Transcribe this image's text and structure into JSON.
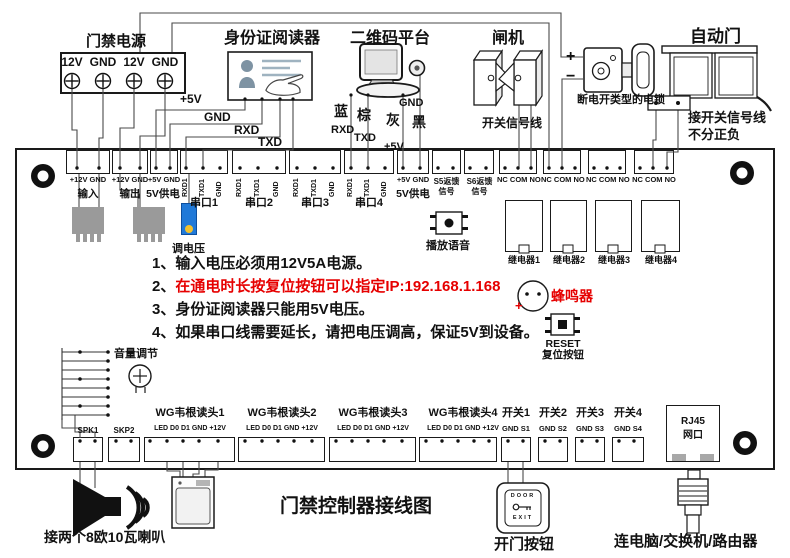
{
  "title": "门禁控制器接线图",
  "colors": {
    "wire": "#4a4a4a",
    "red": "#e60000",
    "pot_blue": "#2079d8",
    "pot_dot": "#f2c12e",
    "chip_gray": "#9a9a9a"
  },
  "top": {
    "power": {
      "title": "门禁电源",
      "t1": "12V",
      "t2": "GND",
      "t3": "12V",
      "t4": "GND"
    },
    "reader": {
      "title": "身份证阅读器",
      "w1": "+5V",
      "w2": "GND",
      "w3": "RXD",
      "w4": "TXD"
    },
    "qr": {
      "title": "二维码平台",
      "c1": "蓝",
      "c2": "棕",
      "c3": "灰",
      "c4": "黑",
      "s1": "RXD",
      "s2": "TXD",
      "s3": "+5V",
      "s4": "GND"
    },
    "gate": {
      "title": "闸机",
      "note": "开关信号线"
    },
    "lock": {
      "plus": "+",
      "minus": "−",
      "label": "断电开类型的电锁"
    },
    "door": {
      "title": "自动门",
      "note1": "接开关信号线",
      "note2": "不分正负"
    }
  },
  "board": {
    "in": {
      "pins": "+12V GND",
      "label": "输入"
    },
    "out": {
      "pins": "+12V GND",
      "label": "输出"
    },
    "v5a": {
      "pins": "+5V GND",
      "label": "5V供电"
    },
    "serial": [
      {
        "p1": "RXD1",
        "p2": "TXD1",
        "p3": "GND",
        "label": "串口1"
      },
      {
        "p1": "RXD1",
        "p2": "TXD1",
        "p3": "GND",
        "label": "串口2"
      },
      {
        "p1": "RXD1",
        "p2": "TXD1",
        "p3": "GND",
        "label": "串口3"
      },
      {
        "p1": "RXD1",
        "p2": "TXD1",
        "p3": "GND",
        "label": "串口4"
      }
    ],
    "v5b": {
      "pins": "+5V GND",
      "label": "5V供电"
    },
    "s5": {
      "l1": "S5返馈",
      "l2": "信号"
    },
    "s6": {
      "l1": "S6返馈",
      "l2": "信号"
    },
    "relay_pins": "NC COM NO",
    "relays": [
      "继电器1",
      "继电器2",
      "继电器3",
      "继电器4"
    ],
    "pot": "调电压",
    "voice": "播放语音",
    "buzzer": {
      "label": "蜂鸣器",
      "plus": "+"
    },
    "reset": {
      "l1": "RESET",
      "l2": "复位按钮"
    },
    "volume": "音量调节",
    "notes": {
      "n1": "1、输入电压必须用12V5A电源。",
      "n2a": "2、",
      "n2b": "在通电时长按复位按钮可以指定IP:192.168.1.168",
      "n3": "3、身份证阅读器只能用5V电压。",
      "n4": "4、如果串口线需要延长，请把电压调高，保证5V到设备。"
    },
    "spk1": "SPK1",
    "skp2": "SKP2",
    "wg": [
      {
        "label": "WG韦根读头1",
        "pins": "LED D0 D1 GND +12V"
      },
      {
        "label": "WG韦根读头2",
        "pins": "LED D0 D1 GND +12V"
      },
      {
        "label": "WG韦根读头3",
        "pins": "LED D0 D1 GND +12V"
      },
      {
        "label": "WG韦根读头4",
        "pins": "LED D0 D1 GND +12V"
      }
    ],
    "sw": [
      {
        "label": "开关1",
        "pins": "GND S1"
      },
      {
        "label": "开关2",
        "pins": "GND S2"
      },
      {
        "label": "开关3",
        "pins": "GND S3"
      },
      {
        "label": "开关4",
        "pins": "GND S4"
      }
    ],
    "rj45": {
      "l1": "RJ45",
      "l2": "网口"
    }
  },
  "bottom": {
    "speaker_note": "接两个8欧10瓦喇叭",
    "button": {
      "door": "DOOR",
      "exit": "EXIT",
      "label": "开门按钮"
    },
    "net_note": "连电脑/交换机/路由器"
  }
}
